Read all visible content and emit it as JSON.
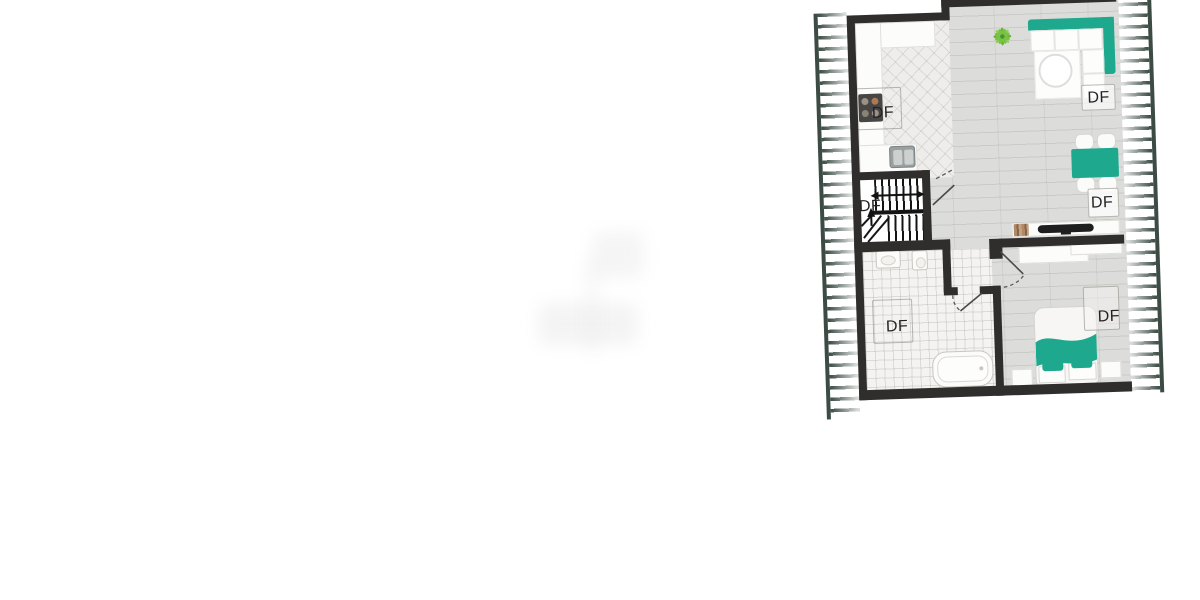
{
  "canvas": {
    "width": 1200,
    "height": 600,
    "background": "#ffffff"
  },
  "floorplan": {
    "type": "attic-floor-plan",
    "rotation_deg": -1.9,
    "colors": {
      "wall": "#2f2e2c",
      "accent_teal": "#1ea98e",
      "roof_hatch": "#3c4c45",
      "wood_floor": "#dcddda",
      "bath_tile": "#f4f3f1"
    },
    "rooms": {
      "kitchen": {
        "skylight_label": "DF"
      },
      "stairs": {
        "skylight_label": "DF"
      },
      "living": {
        "skylight_label": "DF"
      },
      "dining": {
        "skylight_label": "DF"
      },
      "bathroom": {
        "skylight_label": "DF"
      },
      "bedroom": {
        "skylight_label": "DF"
      }
    }
  }
}
